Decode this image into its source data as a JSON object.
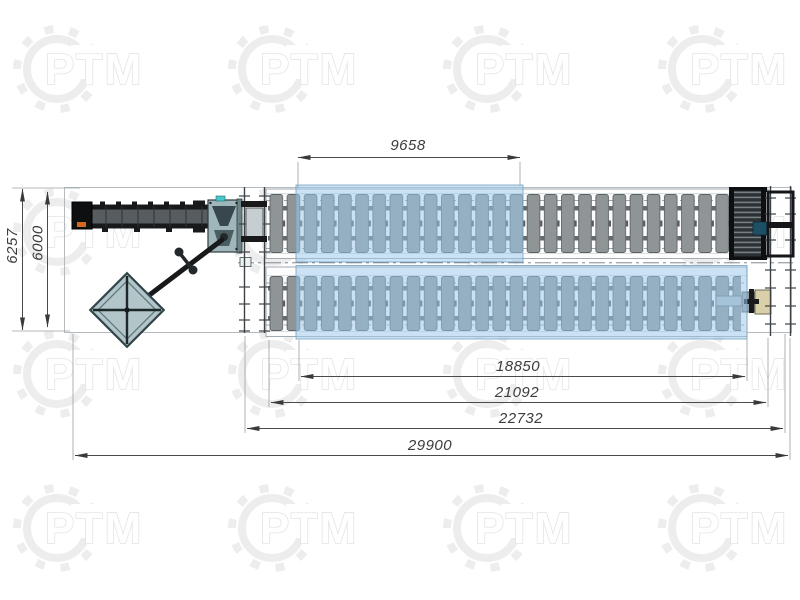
{
  "drawing": {
    "type": "plan-view technical drawing of slat conveyor line",
    "watermark": {
      "text": "РТМ"
    },
    "dimensions": {
      "top": {
        "label": "9658"
      },
      "bottom": [
        {
          "label": "18850"
        },
        {
          "label": "21092"
        },
        {
          "label": "22732"
        },
        {
          "label": "29900"
        }
      ],
      "left": [
        {
          "label": "6257"
        },
        {
          "label": "6000"
        }
      ]
    }
  },
  "colors": {
    "blueZone": "#9ccaea",
    "blueZoneBorder": "#6e9cbe",
    "slatGray": "#8f9497",
    "slatBorder": "#5c6165",
    "frameDark": "#17191b",
    "machineTeal": "#9fb6ba",
    "cyanAccent": "#49c7cd",
    "orangeAccent": "#d4691e",
    "beigeBox": "#d9cfa8",
    "dimLine": "#4a4a4a",
    "watermark": "#ededed"
  }
}
